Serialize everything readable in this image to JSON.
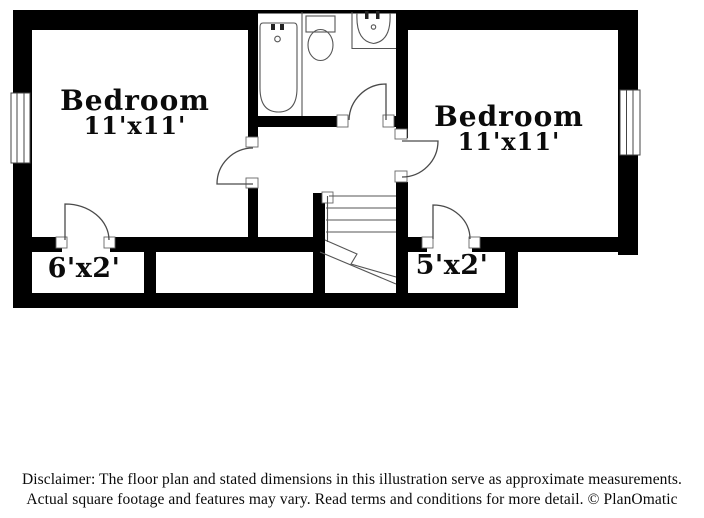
{
  "plan": {
    "type": "floor-plan",
    "rooms": {
      "bedroom_left": {
        "label": "Bedroom",
        "dims": "11'x11'"
      },
      "bedroom_right": {
        "label": "Bedroom",
        "dims": "11'x11'"
      },
      "closet_left": {
        "dims": "6'x2'"
      },
      "closet_right": {
        "dims": "5'x2'"
      }
    },
    "fixtures": [
      "bathtub",
      "toilet",
      "sink",
      "staircase",
      "window",
      "door"
    ],
    "colors": {
      "wall": "#000000",
      "background": "#ffffff",
      "fixture_line": "#555555",
      "text": "#0b0b0b"
    }
  },
  "disclaimer": {
    "line1": "Disclaimer: The floor plan and stated dimensions in this illustration serve as approximate measurements.",
    "line2": "Actual square footage and features may vary. Read terms and conditions for more detail. © PlanOmatic"
  }
}
